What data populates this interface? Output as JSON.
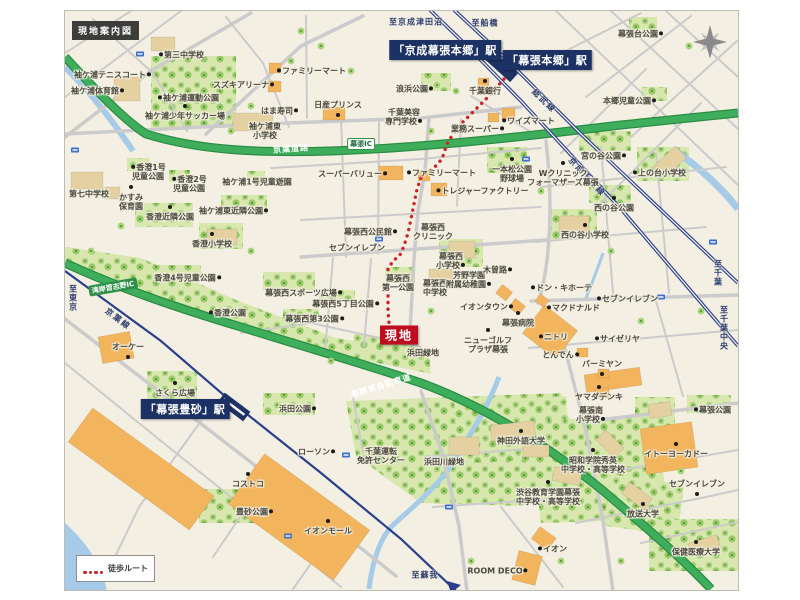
{
  "title": "現地案内図",
  "legend": {
    "route_label": "徒歩ルート"
  },
  "site": {
    "label": "現地",
    "x": 398,
    "y": 334
  },
  "colors": {
    "site_red": "#bf0d20",
    "route_red": "#c9252b",
    "station_navy": "#1d3264",
    "highway_green": "#3fae5c",
    "park_green": "#d7e7ae",
    "water_blue": "#a5cbe8"
  },
  "stations": [
    {
      "name": "「京成幕張本郷」駅",
      "x": 444,
      "y": 49
    },
    {
      "name": "「幕張本郷」駅",
      "x": 546,
      "y": 59
    },
    {
      "name": "「幕張豊砂」駅",
      "x": 184,
      "y": 408
    }
  ],
  "direction_labels": [
    {
      "text": "至京成津田沼",
      "x": 415,
      "y": 21,
      "vertical": false
    },
    {
      "text": "至船橋",
      "x": 484,
      "y": 22,
      "vertical": false
    },
    {
      "text": "至東京",
      "x": 72,
      "y": 297,
      "vertical": true
    },
    {
      "text": "至千葉",
      "x": 717,
      "y": 272,
      "vertical": true
    },
    {
      "text": "至千葉中央",
      "x": 723,
      "y": 327,
      "vertical": true
    },
    {
      "text": "至蘇我",
      "x": 424,
      "y": 574,
      "vertical": false
    }
  ],
  "rail_labels": [
    {
      "text": "総武線",
      "x": 543,
      "y": 100,
      "rot": 44
    },
    {
      "text": "京成千葉線",
      "x": 586,
      "y": 176,
      "rot": 47
    },
    {
      "text": "京葉線",
      "x": 117,
      "y": 318,
      "rot": 37
    }
  ],
  "road_labels": [
    {
      "text": "京葉道路",
      "x": 290,
      "y": 148,
      "rot": -4,
      "cls": "on-green"
    },
    {
      "text": "幕張IC",
      "x": 360,
      "y": 143,
      "rot": 0,
      "cls": "ic"
    },
    {
      "text": "湾岸習志野IC",
      "x": 112,
      "y": 286,
      "rot": -10,
      "cls": "pill"
    },
    {
      "text": "東関東自動車道",
      "x": 380,
      "y": 385,
      "rot": -17,
      "cls": "on-green"
    }
  ],
  "pois": [
    {
      "text": "第三中学校",
      "x": 180,
      "y": 54,
      "marker": "l"
    },
    {
      "text": "袖ケ浦テニスコート",
      "x": 112,
      "y": 74,
      "marker": "r"
    },
    {
      "text": "袖ケ浦体育館",
      "x": 97,
      "y": 90,
      "marker": "r"
    },
    {
      "text": "袖ケ浦運動公園",
      "x": 187,
      "y": 97,
      "marker": "l"
    },
    {
      "text": "袖ケ浦少年サッカー場",
      "x": 184,
      "y": 115,
      "marker": "a"
    },
    {
      "text": "スズキアリーナ",
      "x": 243,
      "y": 84,
      "marker": "r"
    },
    {
      "text": "ファミリーマート",
      "x": 310,
      "y": 70,
      "marker": "l"
    },
    {
      "text": "はま寿司",
      "x": 279,
      "y": 110,
      "marker": "r"
    },
    {
      "text": "日産プリンス",
      "x": 337,
      "y": 104,
      "marker": "b"
    },
    {
      "text": "浪浜公園",
      "x": 414,
      "y": 88,
      "marker": "r"
    },
    {
      "lines": [
        "千葉美容",
        "専門学校"
      ],
      "x": 403,
      "y": 116,
      "marker": "r"
    },
    {
      "text": "千葉銀行",
      "x": 484,
      "y": 90,
      "marker": "a"
    },
    {
      "text": "ワイズマート",
      "x": 527,
      "y": 120,
      "marker": "l"
    },
    {
      "text": "業務スーパー",
      "x": 477,
      "y": 128,
      "marker": "r"
    },
    {
      "text": "幕張台公園",
      "x": 640,
      "y": 33,
      "marker": "r"
    },
    {
      "text": "本郷児童公園",
      "x": 629,
      "y": 100,
      "marker": "r"
    },
    {
      "text": "宮の谷公園",
      "x": 603,
      "y": 155,
      "marker": "r"
    },
    {
      "text": "上の台小学校",
      "x": 658,
      "y": 172,
      "marker": "l"
    },
    {
      "lines": [
        "一本松公園",
        "野球場"
      ],
      "x": 511,
      "y": 173,
      "marker": "a"
    },
    {
      "lines": [
        "Wクリニック",
        "フォーマザーズ幕張"
      ],
      "x": 562,
      "y": 177,
      "marker": "a"
    },
    {
      "text": "西の谷公園",
      "x": 613,
      "y": 207,
      "marker": "a"
    },
    {
      "text": "西の谷小学校",
      "x": 584,
      "y": 234,
      "marker": "a"
    },
    {
      "text": "トレジャーファクトリー",
      "x": 481,
      "y": 190,
      "marker": "l"
    },
    {
      "lines": [
        "袖ケ浦東",
        "小学校"
      ],
      "x": 264,
      "y": 130,
      "marker": "n"
    },
    {
      "text": "袖ケ浦1号児童遊園",
      "x": 256,
      "y": 181,
      "marker": "n"
    },
    {
      "lines": [
        "香澄1号",
        "児童公園"
      ],
      "x": 147,
      "y": 171,
      "marker": "l"
    },
    {
      "lines": [
        "香澄2号",
        "児童公園"
      ],
      "x": 188,
      "y": 183,
      "marker": "l"
    },
    {
      "text": "第七中学校",
      "x": 88,
      "y": 193,
      "marker": "n"
    },
    {
      "lines": [
        "かすみ",
        "保育園"
      ],
      "x": 130,
      "y": 201,
      "marker": "a"
    },
    {
      "text": "香澄近隣公園",
      "x": 169,
      "y": 216,
      "marker": "a"
    },
    {
      "text": "袖ケ浦東近隣公園",
      "x": 233,
      "y": 210,
      "marker": "r"
    },
    {
      "text": "香澄小学校",
      "x": 211,
      "y": 243,
      "marker": "a"
    },
    {
      "text": "香澄4号児童公園",
      "x": 187,
      "y": 277,
      "marker": "r"
    },
    {
      "text": "香澄公園",
      "x": 226,
      "y": 312,
      "marker": "l"
    },
    {
      "text": "スーパーバリュー",
      "x": 352,
      "y": 173,
      "marker": "r"
    },
    {
      "text": "ファミリーマート",
      "x": 440,
      "y": 172,
      "marker": "l"
    },
    {
      "text": "幕張西公民館",
      "x": 370,
      "y": 231,
      "marker": "r"
    },
    {
      "lines": [
        "幕張西",
        "クリニック"
      ],
      "x": 432,
      "y": 231,
      "marker": "n"
    },
    {
      "text": "セブンイレブン",
      "x": 356,
      "y": 247,
      "marker": "n"
    },
    {
      "lines": [
        "幕張西",
        "小学校"
      ],
      "x": 450,
      "y": 260,
      "marker": "r"
    },
    {
      "lines": [
        "幕張西",
        "第一公園"
      ],
      "x": 397,
      "y": 282,
      "marker": "n"
    },
    {
      "lines": [
        "幕張西",
        "中学校"
      ],
      "x": 434,
      "y": 287,
      "marker": "n"
    },
    {
      "lines": [
        "芳野学園",
        "附属幼稚園"
      ],
      "x": 468,
      "y": 279,
      "marker": "r"
    },
    {
      "text": "木曽路",
      "x": 497,
      "y": 269,
      "marker": "r"
    },
    {
      "text": "イオンタウン",
      "x": 486,
      "y": 306,
      "marker": "r"
    },
    {
      "text": "幕張病院",
      "x": 517,
      "y": 322,
      "marker": "a"
    },
    {
      "text": "ドン・キホーテ",
      "x": 560,
      "y": 287,
      "marker": "l"
    },
    {
      "text": "マクドナルド",
      "x": 572,
      "y": 307,
      "marker": "l"
    },
    {
      "text": "セブンイレブン",
      "x": 626,
      "y": 298,
      "marker": "l"
    },
    {
      "text": "ニトリ",
      "x": 552,
      "y": 336,
      "marker": "l"
    },
    {
      "text": "サイゼリヤ",
      "x": 616,
      "y": 338,
      "marker": "l"
    },
    {
      "text": "とんでん",
      "x": 560,
      "y": 354,
      "marker": "r"
    },
    {
      "text": "バーミヤン",
      "x": 601,
      "y": 363,
      "marker": "b"
    },
    {
      "text": "ヤマダデンキ",
      "x": 598,
      "y": 396,
      "marker": "a"
    },
    {
      "lines": [
        "ニューゴルフ",
        "プラザ幕張"
      ],
      "x": 487,
      "y": 344,
      "marker": "a"
    },
    {
      "text": "幕張西スポーツ広場",
      "x": 303,
      "y": 292,
      "marker": "r"
    },
    {
      "text": "幕張西5丁目公園",
      "x": 345,
      "y": 303,
      "marker": "r"
    },
    {
      "text": "幕張西第3公園",
      "x": 314,
      "y": 318,
      "marker": "r"
    },
    {
      "text": "浜田緑地",
      "x": 422,
      "y": 352,
      "marker": "n"
    },
    {
      "text": "オーケー",
      "x": 127,
      "y": 346,
      "marker": "b"
    },
    {
      "text": "さくら広場",
      "x": 174,
      "y": 392,
      "marker": "a"
    },
    {
      "text": "浜田公園",
      "x": 297,
      "y": 408,
      "marker": "r"
    },
    {
      "text": "ローソン",
      "x": 316,
      "y": 451,
      "marker": "r"
    },
    {
      "lines": [
        "千葉運転",
        "免許センター"
      ],
      "x": 380,
      "y": 455,
      "marker": "n"
    },
    {
      "text": "浜田川緑地",
      "x": 443,
      "y": 461,
      "marker": "n"
    },
    {
      "text": "コストコ",
      "x": 247,
      "y": 483,
      "marker": "a"
    },
    {
      "text": "豊砂公園",
      "x": 254,
      "y": 511,
      "marker": "r"
    },
    {
      "text": "イオンモール",
      "x": 327,
      "y": 530,
      "marker": "a"
    },
    {
      "text": "神田外語大学",
      "x": 520,
      "y": 440,
      "marker": "a"
    },
    {
      "lines": [
        "昭和学院秀英",
        "中学校・高等学校"
      ],
      "x": 592,
      "y": 464,
      "marker": "a"
    },
    {
      "lines": [
        "渋谷教育学園幕張",
        "中学校・高等学校"
      ],
      "x": 547,
      "y": 496,
      "marker": "a"
    },
    {
      "text": "放送大学",
      "x": 642,
      "y": 513,
      "marker": "a"
    },
    {
      "lines": [
        "幕張南",
        "小学校"
      ],
      "x": 590,
      "y": 414,
      "marker": "r"
    },
    {
      "text": "幕張公園",
      "x": 711,
      "y": 409,
      "marker": "l"
    },
    {
      "text": "イトーヨーカドー",
      "x": 675,
      "y": 453,
      "marker": "a"
    },
    {
      "text": "セブンイレブン",
      "x": 696,
      "y": 483,
      "marker": "b"
    },
    {
      "text": "保健医療大学",
      "x": 695,
      "y": 551,
      "marker": "a"
    },
    {
      "text": "ROOM DECO",
      "x": 497,
      "y": 570,
      "marker": "r"
    },
    {
      "text": "イオン",
      "x": 551,
      "y": 548,
      "marker": "l"
    }
  ]
}
